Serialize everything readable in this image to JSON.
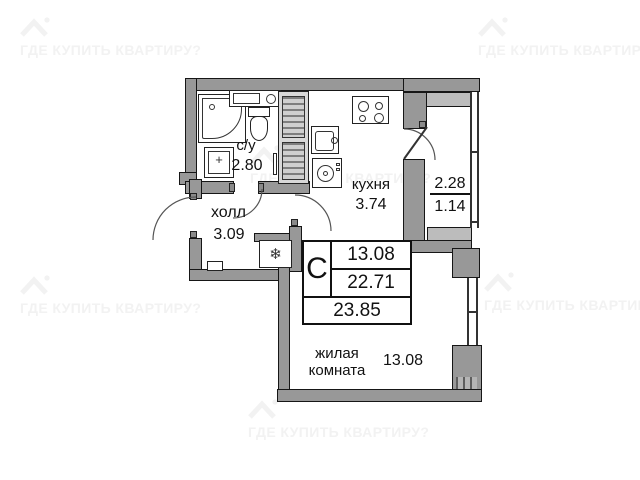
{
  "watermark": {
    "text": "ГДЕ КУПИТЬ КВАРТИРУ?"
  },
  "rooms": {
    "bathroom": {
      "name": "с/у",
      "area": "2.80"
    },
    "hall": {
      "name": "холл",
      "area": "3.09"
    },
    "kitchen": {
      "name": "кухня",
      "area": "3.74"
    },
    "balcony": {
      "area": "2.28",
      "area_reduced": "1.14"
    },
    "living": {
      "name_line1": "жилая",
      "name_line2": "комната",
      "area": "13.08"
    }
  },
  "stamp": {
    "type_label": "С",
    "living_area": "13.08",
    "apartment_area": "22.71",
    "total_area": "23.85"
  },
  "symbols": {
    "fridge": "❄"
  }
}
